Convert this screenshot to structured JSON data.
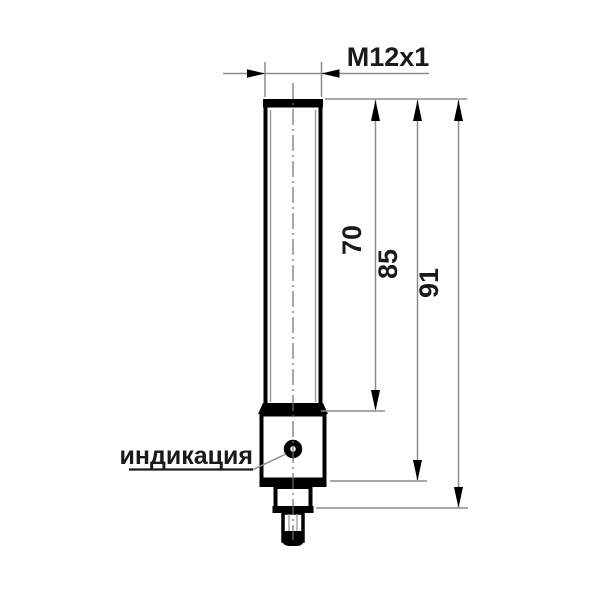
{
  "drawing": {
    "type": "technical-dimension-drawing",
    "subject": "cylindrical threaded sensor, side view",
    "thread_label": "M12x1",
    "dimensions": [
      {
        "id": "thread-length",
        "value": "70"
      },
      {
        "id": "body-length",
        "value": "85"
      },
      {
        "id": "overall-length",
        "value": "91"
      }
    ],
    "callout": {
      "label": "индикация"
    },
    "colors": {
      "outline": "#000000",
      "dimension_line": "#8c8c8c",
      "background": "#ffffff"
    }
  }
}
